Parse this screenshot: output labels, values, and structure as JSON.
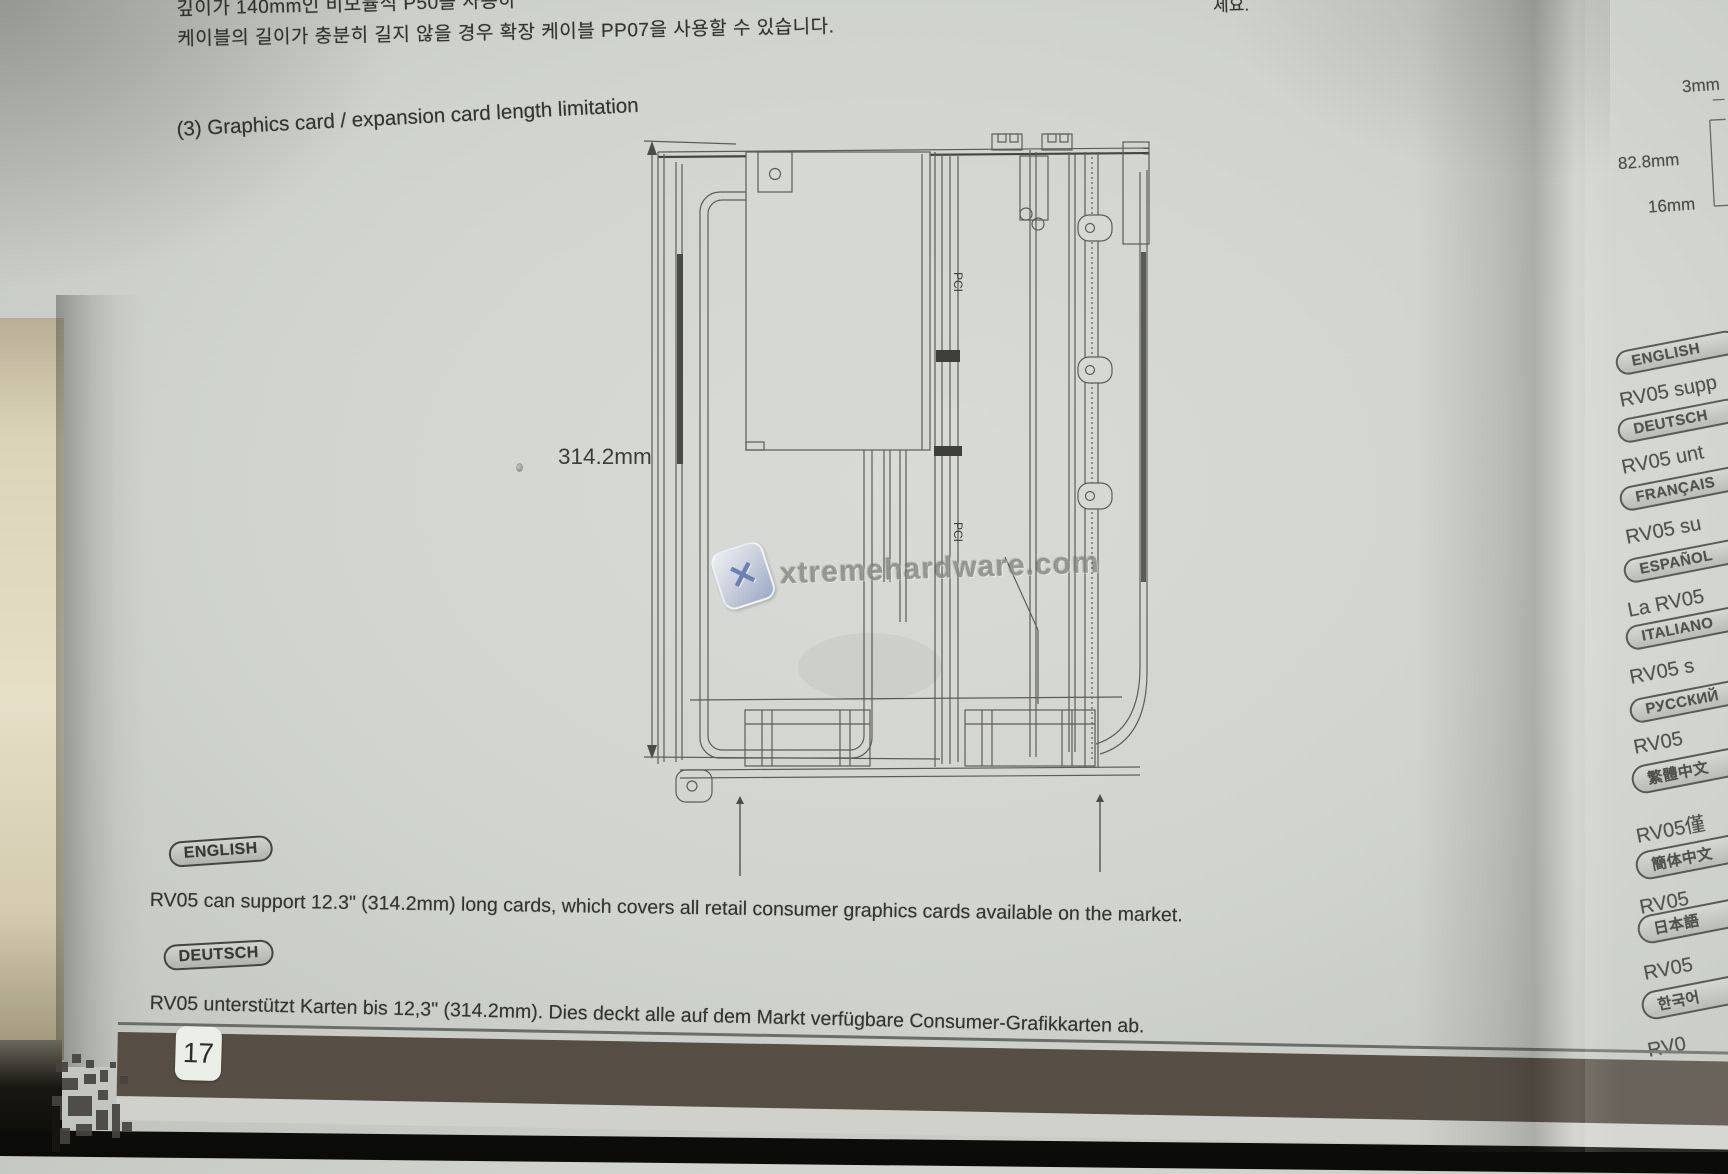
{
  "page": {
    "korean_line1": "깊이가 140mm인 비모듈식 P50을 사용하",
    "korean_line2": "케이블의 길이가 충분히 길지 않을 경우 확장 케이블 PP07을 사용할 수 있습니다.",
    "top_right_fragment": "세요.",
    "heading": "(3) Graphics card / expansion card length limitation",
    "diagram": {
      "dimension_label": "314.2mm",
      "pci_label": "PCI"
    },
    "watermark": {
      "text": "xtremehardware.com",
      "logo_glyph": "✕"
    },
    "sections": [
      {
        "badge": "ENGLISH",
        "text": "RV05 can support 12.3\" (314.2mm) long cards, which covers all retail consumer graphics cards available on the market."
      },
      {
        "badge": "DEUTSCH",
        "text": "RV05 unterstützt Karten bis 12,3\" (314.2mm). Dies deckt alle auf dem Markt verfügbare Consumer-Grafikkarten ab."
      }
    ],
    "page_number": "17"
  },
  "next_page": {
    "dims": {
      "top": "3mm",
      "middle": "82.8mm",
      "bottom": "16mm"
    },
    "items": [
      {
        "type": "badge",
        "label": "ENGLISH"
      },
      {
        "type": "text",
        "label": "RV05 supp"
      },
      {
        "type": "badge",
        "label": "DEUTSCH"
      },
      {
        "type": "text",
        "label": "RV05 unt"
      },
      {
        "type": "badge",
        "label": "FRANÇAIS"
      },
      {
        "type": "text",
        "label": "RV05 su"
      },
      {
        "type": "badge",
        "label": "ESPAÑOL"
      },
      {
        "type": "text",
        "label": "La RV05"
      },
      {
        "type": "badge",
        "label": "ITALIANO"
      },
      {
        "type": "text",
        "label": "RV05 s"
      },
      {
        "type": "badge",
        "label": "РУССКИЙ"
      },
      {
        "type": "text",
        "label": "RV05"
      },
      {
        "type": "badge",
        "label": "繁體中文"
      },
      {
        "type": "text",
        "label": "RV05僅"
      },
      {
        "type": "badge",
        "label": "簡体中文"
      },
      {
        "type": "text",
        "label": "RV05"
      },
      {
        "type": "badge",
        "label": "日本語"
      },
      {
        "type": "text",
        "label": "RV05"
      },
      {
        "type": "badge",
        "label": "한국어"
      },
      {
        "type": "text",
        "label": "RV0"
      }
    ]
  },
  "colors": {
    "band": "#564e45",
    "paper": "#d6d9d3",
    "accent_blue": "#6d86bb",
    "ink": "#3a3a34"
  }
}
